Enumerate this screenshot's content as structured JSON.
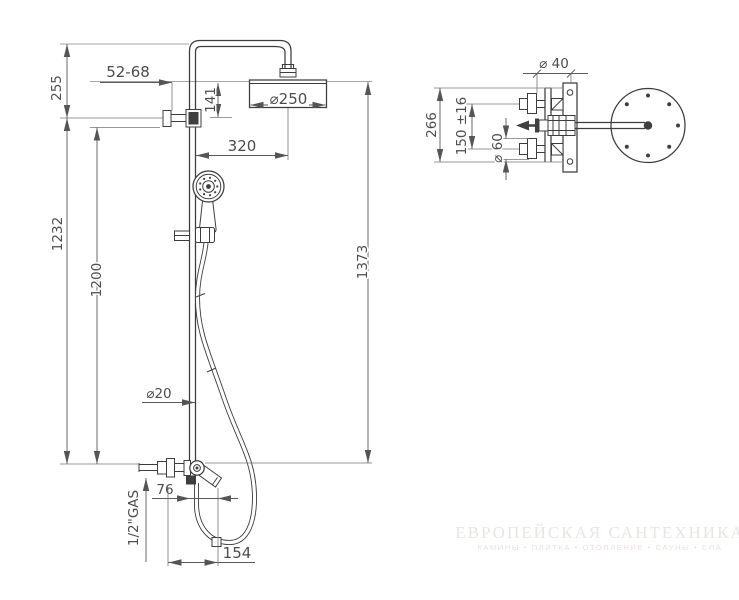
{
  "drawing": {
    "front": {
      "adjust": "52-68",
      "wall_offset_top": "255",
      "head_drop": "141",
      "head_diameter": "⌀250",
      "arm_reach": "320",
      "bracket_to_outlet": "1232",
      "rail_length": "1200",
      "overall_height": "1373",
      "pipe_diameter": "⌀20",
      "spout_offset": "76",
      "thread": "1/2\"GAS",
      "hose_loop": "154"
    },
    "side": {
      "arm_diameter": "⌀ 40",
      "overall_depth": "266",
      "inlet_spacing": "150 ±16",
      "escutcheon_diameter": "⌀ 60"
    }
  },
  "watermark": {
    "title": "ЕВРОПЕЙСКАЯ САНТЕХНИКА",
    "subtitle": "КАМИНЫ • ПЛИТКА • ОТОПЛЕНИЕ • САУНЫ • СПА"
  }
}
